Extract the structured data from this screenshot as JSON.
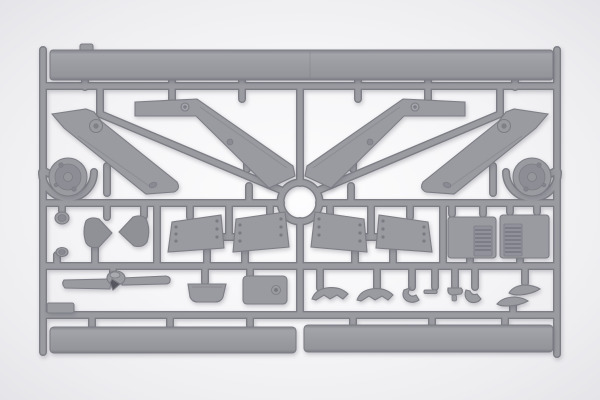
{
  "scene": {
    "subject": "Injection-molded grey plastic model kit sprue with aircraft parts photographed on a light backdrop",
    "palette": {
      "background_edge": "#e6e6e9",
      "background_glow": "#fdfdfe",
      "plastic_mid": "#9a9ba1",
      "plastic_light": "#a9aab0",
      "plastic_dark": "#7d7e85",
      "plastic_deep": "#8d8e95",
      "detail_dark": "#55565e"
    },
    "parts_inventory": {
      "long_top_rail_part": 1,
      "vertical_tail_fins": 4,
      "main_wheels": 2,
      "elevator_panels": 4,
      "radiator_blocks": 2,
      "cowling_halves": 2,
      "hub_caps": 2,
      "two_blade_propeller": 1,
      "cowl_tub": 1,
      "equipment_box": 1,
      "small_fairings_and_clips": 8,
      "long_bottom_strips": 2,
      "center_sprue_ring": 1
    }
  }
}
